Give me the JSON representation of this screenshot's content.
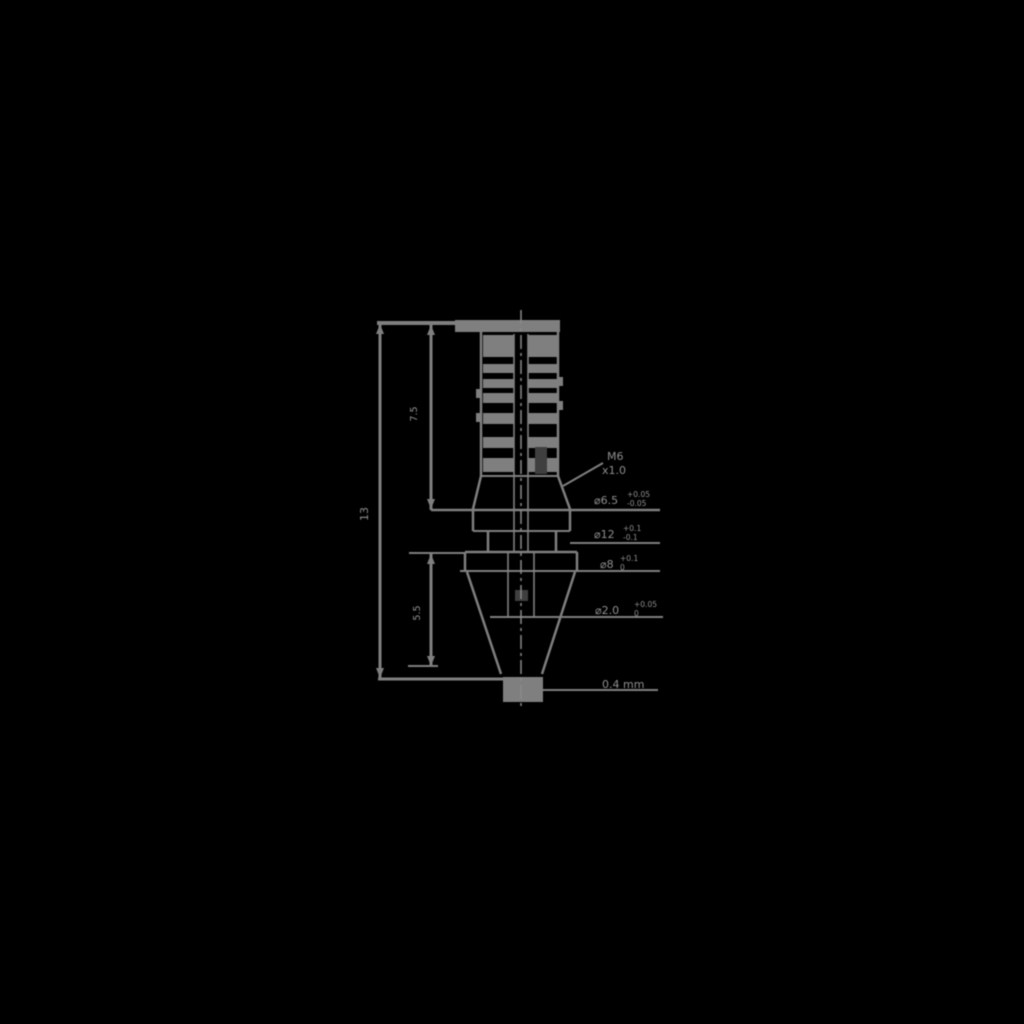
{
  "colors": {
    "background": "#000000",
    "line": "#7f7f7f",
    "line_dark": "#3f3f3f",
    "text": "#8f8f8f"
  },
  "drawing": {
    "kind": "nozzle-cross-section-technical-drawing",
    "dimension_labels": {
      "overall_height": "13",
      "upper_section_height": "7.5",
      "lower_section_height": "5.5"
    },
    "callouts": {
      "thread_line1": "M6",
      "thread_line2": "x1.0",
      "flange_dia_value": "⌀6.5",
      "flange_dia_tol_upper": "+0.05",
      "flange_dia_tol_lower": "-0.05",
      "body_dia_value": "⌀12",
      "body_dia_tol_upper": "+0.1",
      "body_dia_tol_lower": "-0.1",
      "hex_dia_value": "⌀8",
      "hex_dia_tol_upper": "+0.1",
      "hex_dia_tol_lower": "0",
      "bore_dia_value": "⌀2.0",
      "bore_dia_tol_upper": "+0.05",
      "bore_dia_tol_lower": "0",
      "tip_orifice": "0.4 mm"
    }
  }
}
